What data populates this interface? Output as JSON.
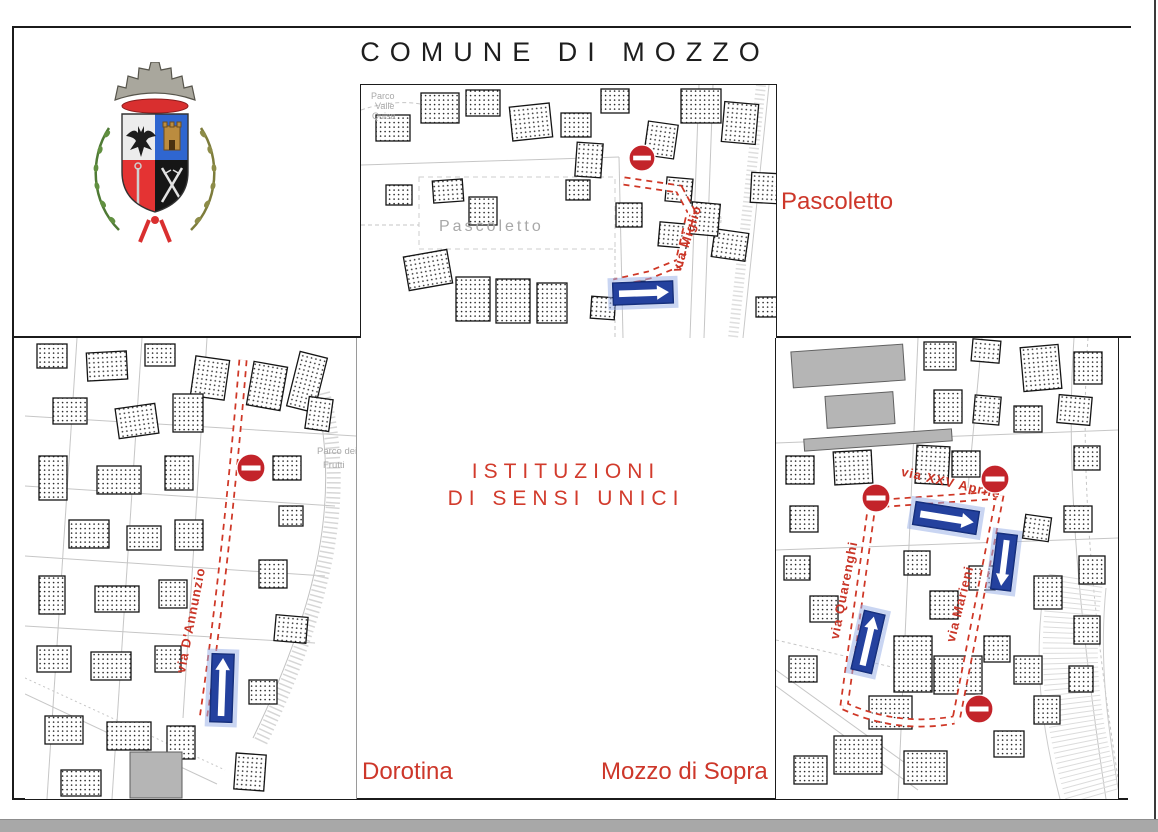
{
  "page": {
    "title": "COMUNE DI MOZZO",
    "center_heading": {
      "line1": "ISTITUZIONI",
      "line2": "DI SENSI UNICI"
    },
    "colors": {
      "heading_red": "#d23b2c",
      "label_red": "#cd372a",
      "route_red": "#cf3726",
      "sign_red": "#c3242a",
      "arrow_blue": "#24419e",
      "map_line_grey": "#c4c4c4"
    }
  },
  "icons": {
    "coat_of_arms": "mozzo-coat-of-arms",
    "no_entry": "no-entry-sign",
    "one_way": "one-way-arrow-sign"
  },
  "panels": {
    "pascoletto": {
      "title_label": "Pascoletto",
      "street_label": "via Miglio",
      "area_label": "Pascoletto",
      "park_label": [
        "Parco",
        "Valle",
        "Quisa"
      ]
    },
    "dorotina": {
      "title_label": "Dorotina",
      "street_label": "via D'Annunzio",
      "park_label": [
        "Parco dei",
        "Frutti"
      ]
    },
    "mozzo_di_sopra": {
      "title_label": "Mozzo di Sopra",
      "street_labels": {
        "xxv_aprile": "via XXV Aprile",
        "quarenghi": "via Quarenghi",
        "marieni": "via Marieni"
      }
    }
  }
}
